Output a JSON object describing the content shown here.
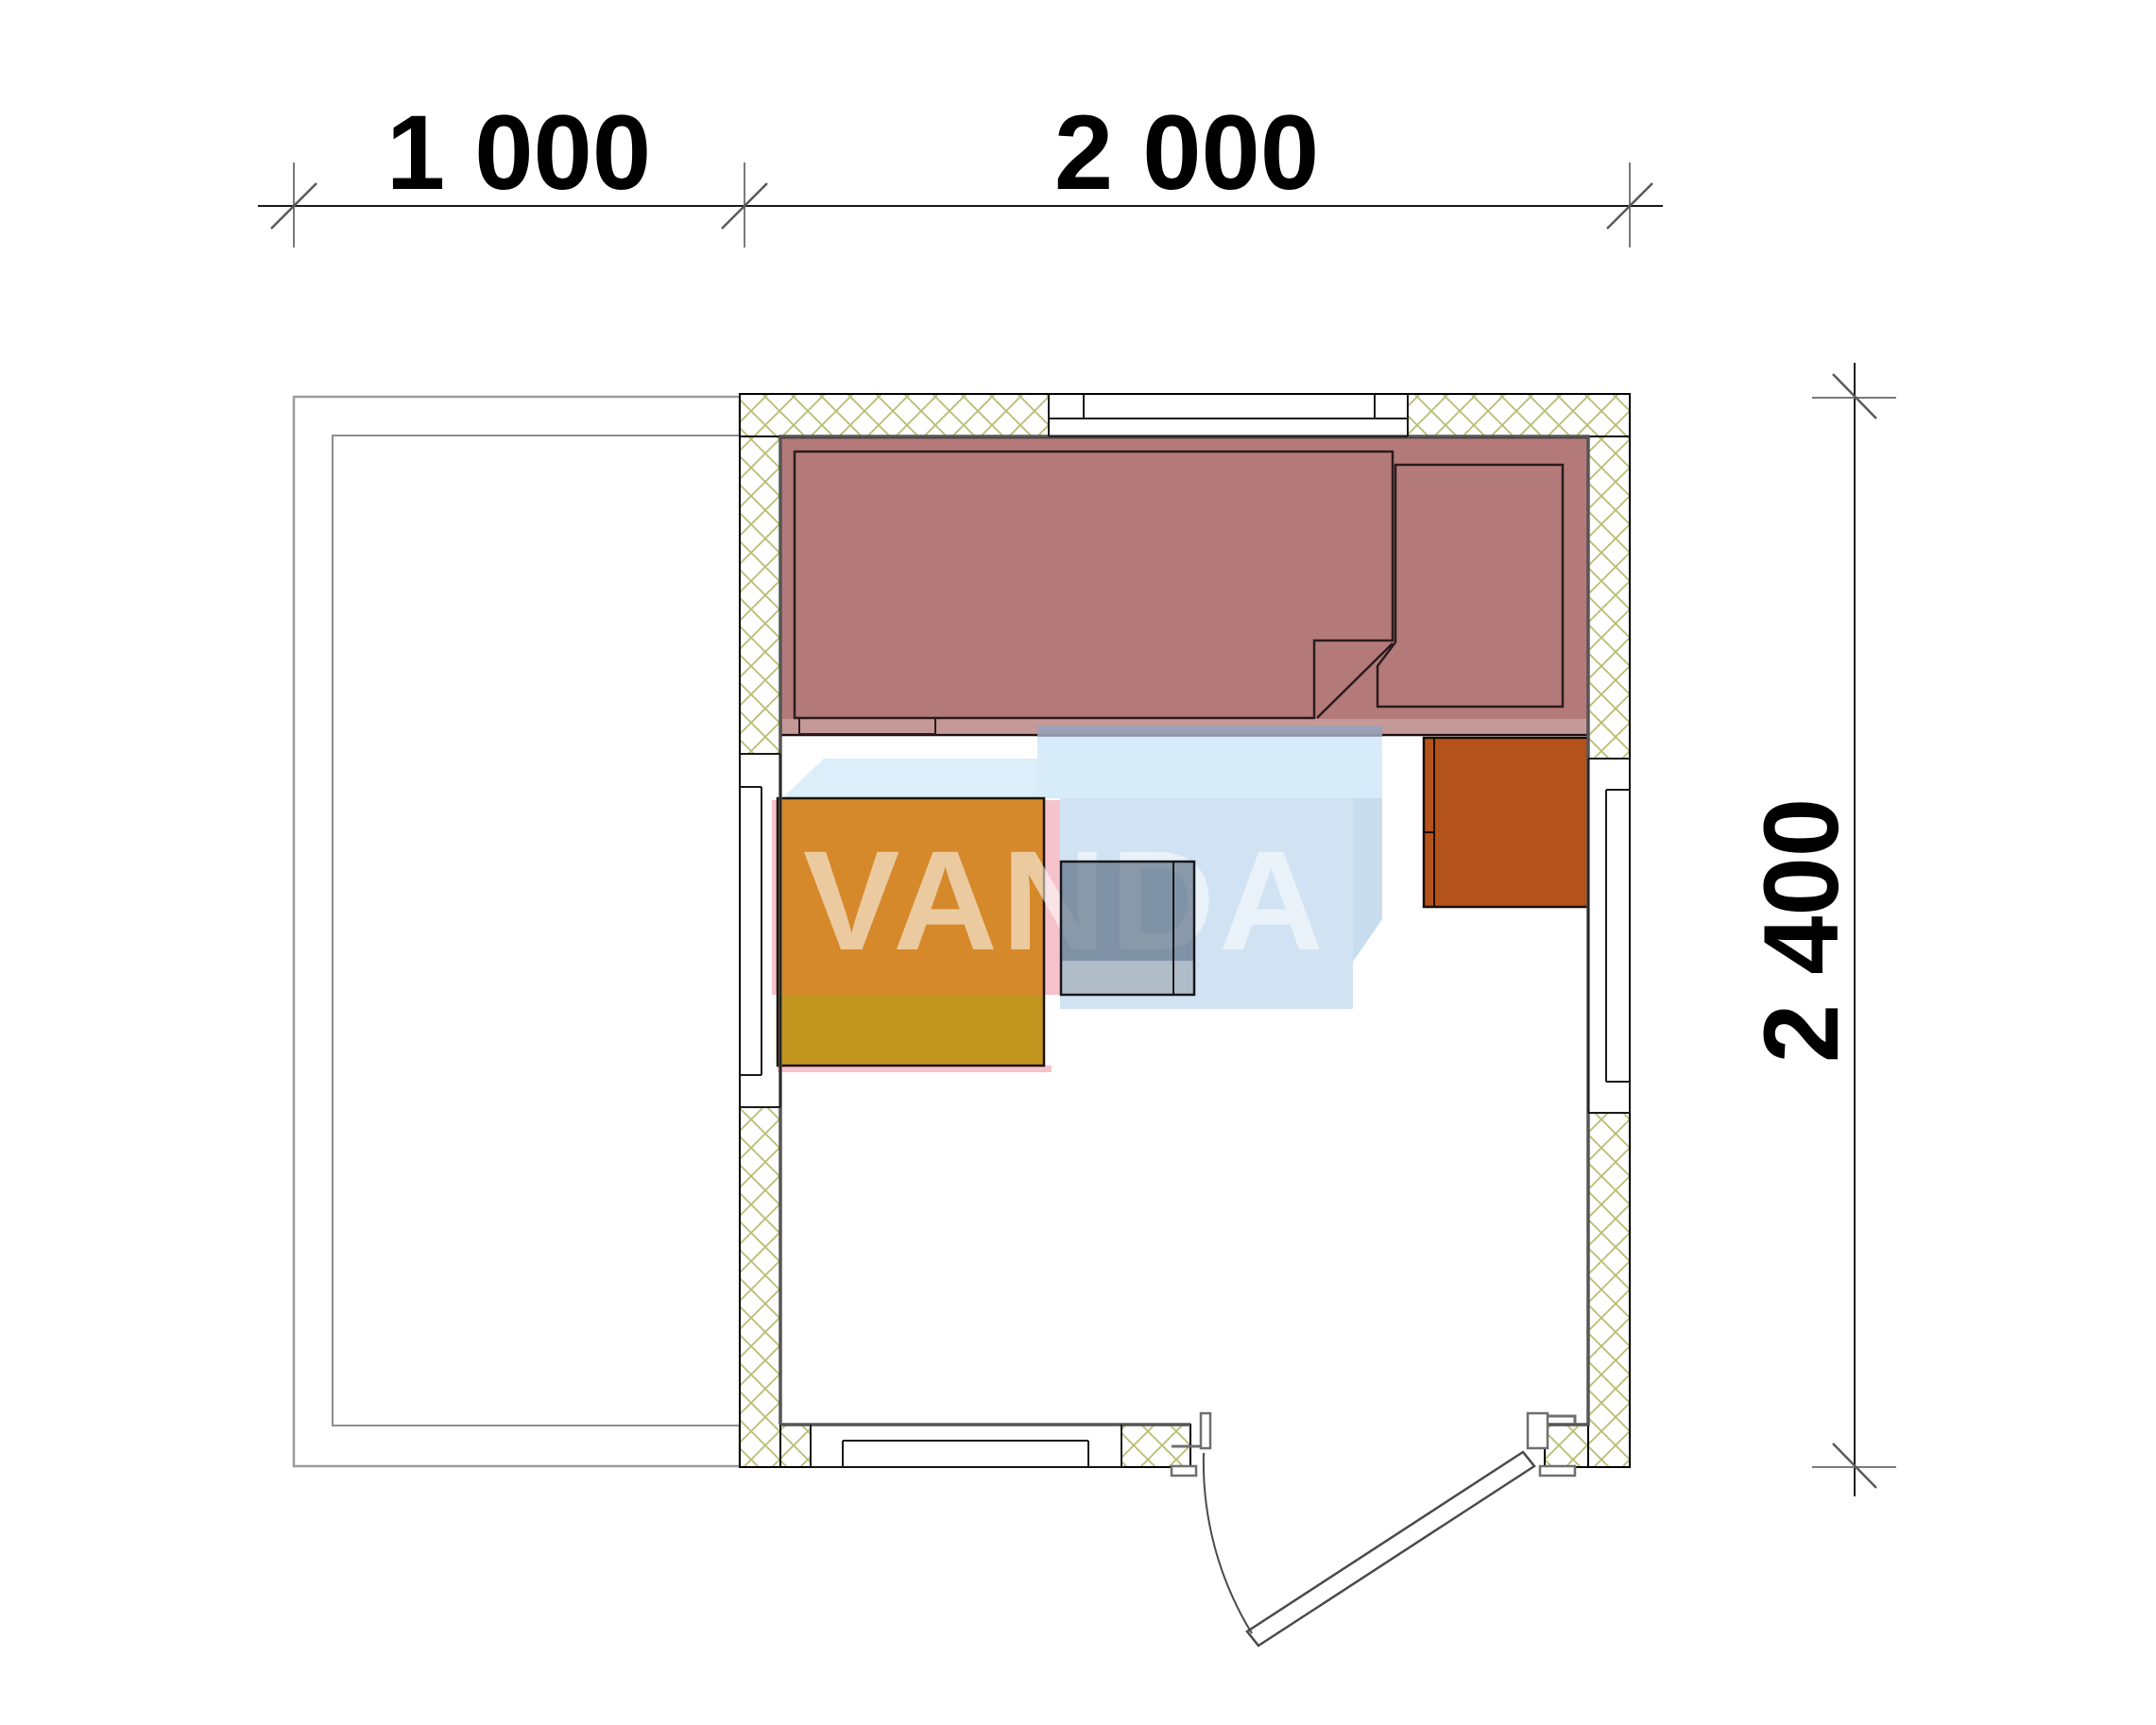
{
  "drawing": {
    "type": "floor-plan",
    "watermark_text": "VANDA",
    "dimensions": {
      "top": [
        {
          "label": "1 000",
          "mm": 1000
        },
        {
          "label": "2 000",
          "mm": 2000
        }
      ],
      "right": [
        {
          "label": "2 400",
          "mm": 2400
        }
      ]
    },
    "elements": {
      "terrace": "open terrace (left, 1000 mm deep)",
      "bed": "bed platform with two mattresses and step",
      "bench": "bench / table (orange, two-tone)",
      "stove": "stove (translucent gray, hinged door)",
      "heater": "sauna heater cabinet (dark orange)",
      "windows": [
        "top wall window",
        "left wall window",
        "right wall window",
        "bottom wall window"
      ],
      "door": "outward swinging entrance door, bottom wall right"
    },
    "colors": {
      "bed": "#b47a7a",
      "bed_outline": "#2b1b1b",
      "bed_strip": "rgba(255,255,255,0.24)",
      "bench_upper": "#d5892b",
      "bench_lower": "#c2961e",
      "heater": "#b4521b",
      "stove_fill": "rgba(73,94,115,0.60)",
      "stove_bottom": "rgba(255,255,255,0.38)",
      "hatch_line": "#b9bd72",
      "wall_line": "#000000",
      "inner_face_line": "#555555",
      "terrace_line": "#9b9b9b",
      "door_line": "#6f6f6f",
      "leaf_line": "#4a4a4a",
      "dim_line": "#1a1a1a",
      "dim_aux": "#7a7a7a",
      "wm_pink": "#f6c3cc",
      "wm_blue_back": "#98a1b8",
      "wm_blue_top": "#d6eaf8",
      "wm_blue_top_left": "#d9edf9",
      "wm_blue_front": "#cde1f1",
      "wm_blue_side": "#c3daed"
    }
  }
}
